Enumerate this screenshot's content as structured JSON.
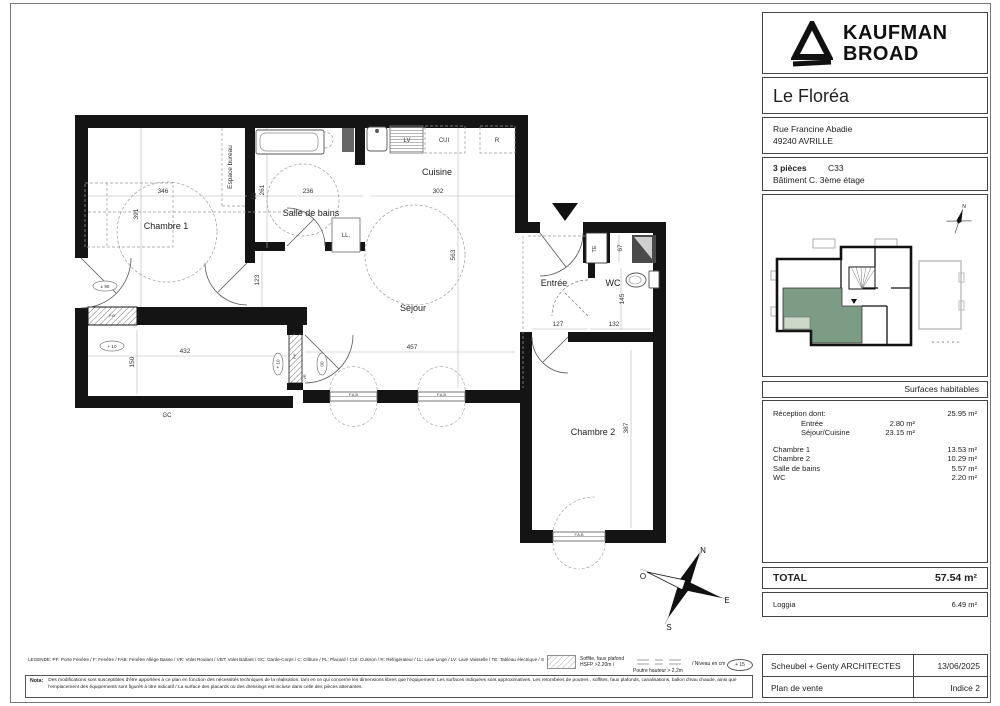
{
  "panel": {
    "brand": {
      "line1": "KAUFMAN",
      "line2": "BROAD"
    },
    "project_title": "Le Floréa",
    "address": {
      "line1": "Rue Francine Abadie",
      "line2": "49240 AVRILLE"
    },
    "unit": {
      "rooms": "3 pièces",
      "number": "C33",
      "location": "Bâtiment C. 3ème étage"
    },
    "key_plan": {
      "compass_north": "N"
    },
    "surfaces": {
      "title": "Surfaces habitables",
      "rows": [
        {
          "label": "Réception dont:",
          "mid": "",
          "value": "25.95 m²"
        },
        {
          "label": "Entrée",
          "mid": "2.80 m²",
          "value": ""
        },
        {
          "label": "Séjour/Cuisine",
          "mid": "23.15 m²",
          "value": ""
        },
        {
          "label": "Chambre 1",
          "mid": "",
          "value": "13.53 m²"
        },
        {
          "label": "Chambre 2",
          "mid": "",
          "value": "10.29 m²"
        },
        {
          "label": "Salle de bains",
          "mid": "",
          "value": "5.57 m²"
        },
        {
          "label": "WC",
          "mid": "",
          "value": "2.20 m²"
        }
      ],
      "total_label": "TOTAL",
      "total_value": "57.54 m²",
      "loggia_label": "Loggia",
      "loggia_value": "6.49 m²"
    },
    "title_block": {
      "architect": "Scheubel + Genty ARCHITECTES",
      "date": "13/06/2025",
      "doc": "Plan de vente",
      "indice": "Indice 2"
    }
  },
  "plan": {
    "rooms": {
      "chambre1": "Chambre 1",
      "sdb": "Salle de bains",
      "cuisine": "Cuisine",
      "sejour": "Séjour",
      "entree": "Entrée",
      "wc": "WC",
      "chambre2": "Chambre 2",
      "bureau": "Espace bureau"
    },
    "equip": {
      "lv": "LV",
      "cui": "CUI",
      "r": "R",
      "ll": "LL.",
      "te": "TE",
      "gc": "GC",
      "pf": "P.F",
      "vr": "VR",
      "fab": "F.A.B",
      "fb": "F.B"
    },
    "dims": {
      "d346": "346",
      "d391": "391",
      "d55": "55",
      "d261": "261",
      "d236": "236",
      "d302": "302",
      "d563": "563",
      "d123": "123",
      "d127": "127",
      "d132": "132",
      "d67": "67",
      "d145": "145",
      "d457": "457",
      "d432": "432",
      "d150": "150",
      "d387": "387"
    },
    "levels": {
      "l90": "± 90",
      "l10": "+ 10",
      "l10b": "+ 10",
      "l00": "00"
    },
    "compass": {
      "n": "N",
      "s": "S",
      "e": "E",
      "o": "O"
    }
  },
  "footer": {
    "legend": "LEGENDE: PF: Porte Fenêtre / F: Fenêtre / FAB: Fenêtre Allège Basse / VR: Volet Roulant / VBT: Volet Battant / GC: Garde-Corps / C: Clôture / PL: Placard / CUI: Cuisson / R: Réfrigérateur / LL: Lave Linge / LV: Lave Vaisselle / TE: Tableau électrique / SS: Sèche-Serviette /",
    "soffite_line1": "Soffite, faux plafond",
    "soffite_line2": "HSFP >2,20m /",
    "poutre": "Poutre hauteur > 2,2m",
    "niveau": "/ Niveau en cm",
    "niveau_badge": "+ 15",
    "nota_label": "Nota:",
    "nota_line1": "Des modifications sont susceptibles d'être apportées à ce plan en fonction des nécessités techniques de la réalisation, tant en ce qui concerne les dimensions libres que l'équipement. Les surfaces indiquées sont approximatives. Les retombées de poutres , soffites, faux plafonds, canalisations, ballon d'eau chaude, ainsi que",
    "nota_line2": "l'emplacement des équipements sont figurés à titre indicatif / La surface des placards ou des dressings est incluse dans celle des pièces attenantes."
  },
  "colors": {
    "unit_green": "#7d9c85",
    "loggia_green": "#ccd8c8",
    "wall": "#141414"
  }
}
